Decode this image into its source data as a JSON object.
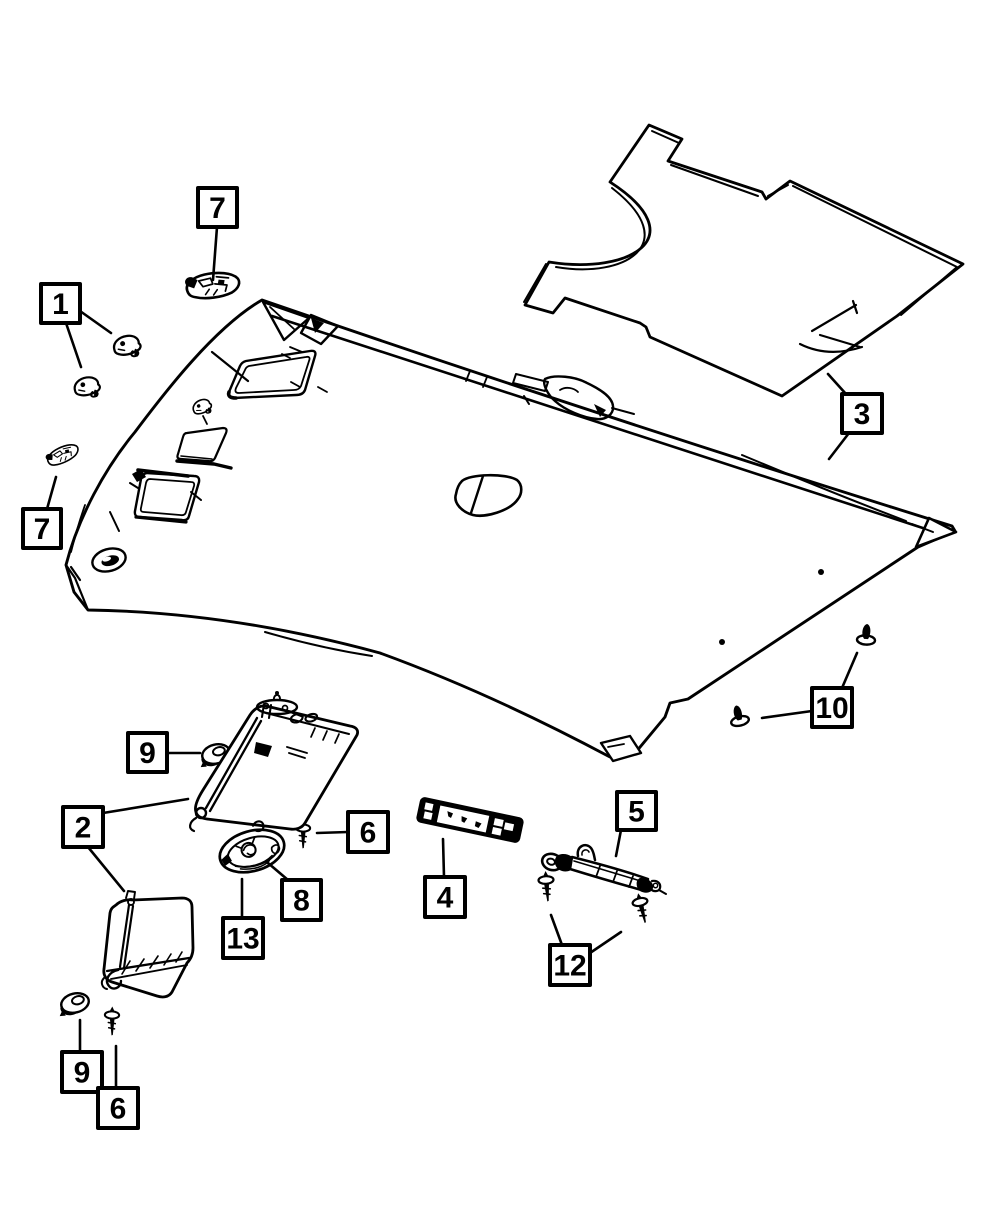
{
  "diagram": {
    "canvas": {
      "width": 1000,
      "height": 1214
    },
    "colors": {
      "background": "#ffffff",
      "line": "#000000"
    },
    "callouts": [
      {
        "label": "7",
        "x": 198,
        "y": 188,
        "w": 39,
        "h": 39,
        "leaders": [
          [
            217,
            227,
            213,
            280
          ]
        ]
      },
      {
        "label": "1",
        "x": 41,
        "y": 284,
        "w": 39,
        "h": 39,
        "leaders": [
          [
            80,
            311,
            111,
            333
          ],
          [
            66,
            323,
            81,
            367
          ]
        ]
      },
      {
        "label": "3",
        "x": 842,
        "y": 394,
        "w": 40,
        "h": 39,
        "leaders": [
          [
            846,
            394,
            828,
            374
          ],
          [
            849,
            433,
            829,
            459
          ]
        ]
      },
      {
        "label": "7",
        "x": 23,
        "y": 509,
        "w": 38,
        "h": 39,
        "leaders": [
          [
            47,
            509,
            56,
            477
          ]
        ]
      },
      {
        "label": "10",
        "x": 812,
        "y": 688,
        "w": 40,
        "h": 39,
        "leaders": [
          [
            842,
            688,
            857,
            653
          ],
          [
            812,
            711,
            762,
            718
          ]
        ]
      },
      {
        "label": "9",
        "x": 128,
        "y": 733,
        "w": 39,
        "h": 39,
        "leaders": [
          [
            167,
            753,
            200,
            753
          ]
        ]
      },
      {
        "label": "2",
        "x": 63,
        "y": 807,
        "w": 40,
        "h": 40,
        "leaders": [
          [
            103,
            813,
            188,
            799
          ],
          [
            88,
            847,
            124,
            891
          ]
        ]
      },
      {
        "label": "6",
        "x": 348,
        "y": 812,
        "w": 40,
        "h": 40,
        "leaders": [
          [
            348,
            832,
            317,
            833
          ]
        ]
      },
      {
        "label": "8",
        "x": 282,
        "y": 880,
        "w": 39,
        "h": 40,
        "leaders": [
          [
            288,
            880,
            268,
            863
          ]
        ]
      },
      {
        "label": "13",
        "x": 223,
        "y": 918,
        "w": 40,
        "h": 40,
        "leaders": [
          [
            242,
            918,
            242,
            879
          ]
        ]
      },
      {
        "label": "4",
        "x": 425,
        "y": 877,
        "w": 40,
        "h": 40,
        "leaders": [
          [
            444,
            877,
            443,
            839
          ]
        ]
      },
      {
        "label": "5",
        "x": 617,
        "y": 792,
        "w": 39,
        "h": 38,
        "leaders": [
          [
            621,
            830,
            616,
            856
          ]
        ]
      },
      {
        "label": "12",
        "x": 550,
        "y": 945,
        "w": 40,
        "h": 40,
        "leaders": [
          [
            562,
            945,
            551,
            915
          ],
          [
            590,
            953,
            621,
            932
          ]
        ]
      },
      {
        "label": "9",
        "x": 62,
        "y": 1052,
        "w": 40,
        "h": 40,
        "leaders": [
          [
            80,
            1052,
            80,
            1020
          ]
        ]
      },
      {
        "label": "6",
        "x": 98,
        "y": 1088,
        "w": 40,
        "h": 40,
        "leaders": [
          [
            116,
            1088,
            116,
            1046
          ]
        ]
      }
    ]
  }
}
